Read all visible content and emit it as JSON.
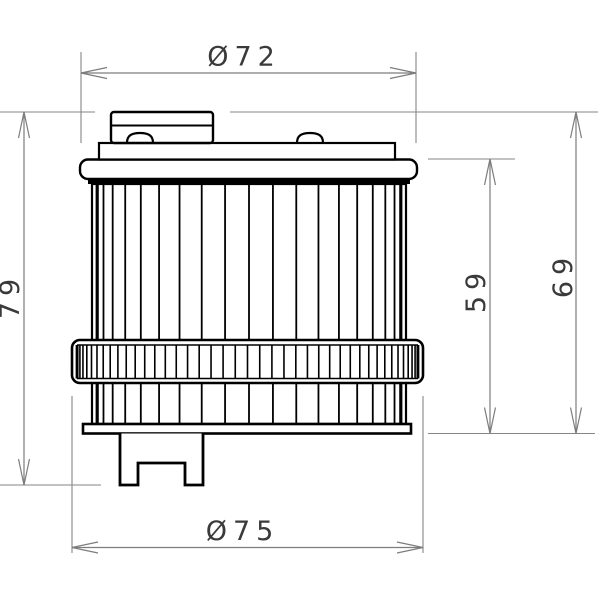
{
  "dims": {
    "top_diameter": {
      "label": "Ø72",
      "value": 72,
      "unit_symbol": "Ø"
    },
    "bottom_diameter": {
      "label": "Ø75",
      "value": 75,
      "unit_symbol": "Ø"
    },
    "overall_height": {
      "label": "79",
      "value": 79
    },
    "case_height": {
      "label": "69",
      "value": 69
    },
    "body_height": {
      "label": "59",
      "value": 59
    }
  },
  "colors": {
    "background": "#ffffff",
    "part_line": "#000000",
    "dimension_line": "#7d7d7d",
    "extension_line": "#868686",
    "dimension_text": "#3a3a3a"
  },
  "drawing": {
    "extension_lines": [
      {
        "x1": 0,
        "y1": 112,
        "x2": 95,
        "y2": 112
      },
      {
        "x1": 230,
        "y1": 112,
        "x2": 598,
        "y2": 112
      },
      {
        "x1": 428,
        "y1": 159,
        "x2": 515,
        "y2": 159
      },
      {
        "x1": 428,
        "y1": 433.5,
        "x2": 595,
        "y2": 433.5
      },
      {
        "x1": 0,
        "y1": 485,
        "x2": 101,
        "y2": 485
      },
      {
        "x1": 81,
        "y1": 52,
        "x2": 81,
        "y2": 143
      },
      {
        "x1": 416,
        "y1": 52,
        "x2": 416,
        "y2": 143
      },
      {
        "x1": 72,
        "y1": 396,
        "x2": 72,
        "y2": 553
      },
      {
        "x1": 423,
        "y1": 396,
        "x2": 423,
        "y2": 553
      }
    ],
    "dimension_lines": [
      {
        "x1": 81,
        "y1": 73,
        "x2": 416,
        "y2": 73
      },
      {
        "x1": 72,
        "y1": 547.5,
        "x2": 423,
        "y2": 547.5
      },
      {
        "x1": 24,
        "y1": 112,
        "x2": 24,
        "y2": 485
      },
      {
        "x1": 490,
        "y1": 159,
        "x2": 490,
        "y2": 433.5
      },
      {
        "x1": 576,
        "y1": 112,
        "x2": 576,
        "y2": 433.5
      }
    ],
    "arrows": [
      {
        "x": 81,
        "y": 73,
        "dir": "left"
      },
      {
        "x": 416,
        "y": 73,
        "dir": "right"
      },
      {
        "x": 72,
        "y": 547.5,
        "dir": "left"
      },
      {
        "x": 423,
        "y": 547.5,
        "dir": "right"
      },
      {
        "x": 24,
        "y": 112,
        "dir": "up"
      },
      {
        "x": 24,
        "y": 485,
        "dir": "down"
      },
      {
        "x": 490,
        "y": 159,
        "dir": "up"
      },
      {
        "x": 490,
        "y": 433.5,
        "dir": "down"
      },
      {
        "x": 576,
        "y": 112,
        "dir": "up"
      },
      {
        "x": 576,
        "y": 433.5,
        "dir": "down"
      }
    ],
    "arrow_length": 26,
    "arrow_spread": 5.5,
    "pleats": {
      "cx": 249.0,
      "r": 153.0,
      "count": 19,
      "y1": 184,
      "y2": 423
    },
    "knurl": {
      "cx": 247.5,
      "r": 171.5,
      "count": 43,
      "y1": 345,
      "y2": 378.5
    }
  }
}
